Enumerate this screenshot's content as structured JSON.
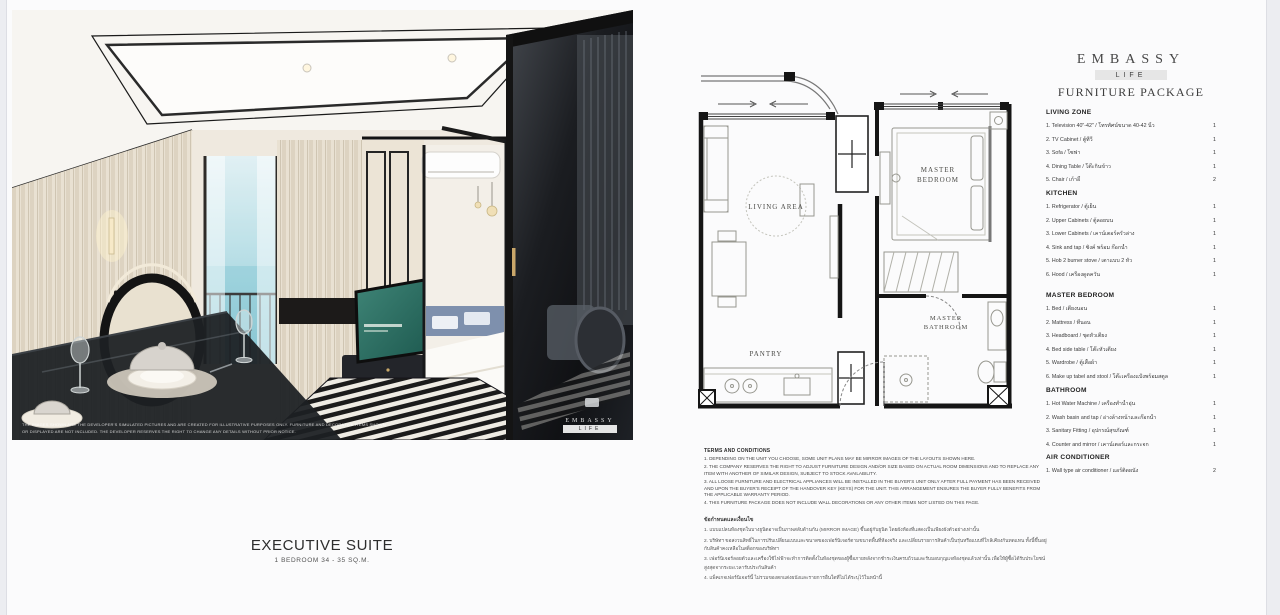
{
  "colors": {
    "page_bg": "#fbfbfc",
    "band_gray": "#e6e6e6",
    "text_dark": "#2f2f2f",
    "plan_wall": "#151515",
    "sea_view": "#8fccd8",
    "tv_screen": "#2e6f63"
  },
  "photo": {
    "watermark_line1": "THE IMAGES SHOWN ARE THE DEVELOPER'S SIMULATED PICTURES AND ARE CREATED FOR ILLUSTRATIVE PURPOSES ONLY. FURNITURE AND DECORATIVE ITEMS SHOWN",
    "watermark_line2": "OR DISPLAYED ARE NOT INCLUDED. THE DEVELOPER RESERVES THE RIGHT TO CHANGE ANY DETAILS WITHOUT PRIOR NOTICE.",
    "logo_name": "EMBASSY",
    "logo_sub": "LIFE"
  },
  "caption": {
    "title": "EXECUTIVE SUITE",
    "subtitle": "1 BEDROOM 34 - 35 SQ.M."
  },
  "floorplan": {
    "labels": {
      "living": "LIVING AREA",
      "bedroom_l1": "MASTER",
      "bedroom_l2": "BEDROOM",
      "pantry": "PANTRY",
      "bathroom_l1": "MASTER",
      "bathroom_l2": "BATHROOM"
    }
  },
  "brand": {
    "name": "EMBASSY",
    "sub": "LIFE",
    "package_title": "FURNITURE PACKAGE"
  },
  "furniture": {
    "sections": [
      {
        "title": "LIVING ZONE",
        "items": [
          {
            "label": "1. Television 40\"-42\" / โทรทัศน์ขนาด 40-42 นิ้ว",
            "qty": "1"
          },
          {
            "label": "2. TV Cabinet / ตู้ทีวี",
            "qty": "1"
          },
          {
            "label": "3. Sofa / โซฟา",
            "qty": "1"
          },
          {
            "label": "4. Dining Table / โต๊ะกินข้าว",
            "qty": "1"
          },
          {
            "label": "5. Chair / เก้าอี้",
            "qty": "2"
          }
        ]
      },
      {
        "title": "KITCHEN",
        "items": [
          {
            "label": "1. Refrigerator / ตู้เย็น",
            "qty": "1"
          },
          {
            "label": "2. Upper Cabinets / ตู้ลอยบน",
            "qty": "1"
          },
          {
            "label": "3. Lower Cabinets / เคาน์เตอร์ครัวล่าง",
            "qty": "1"
          },
          {
            "label": "4. Sink and tap / ซิงค์ พร้อม ก๊อกน้ำ",
            "qty": "1"
          },
          {
            "label": "5. Hob 2 burner stove / เตาแบบ 2 หัว",
            "qty": "1"
          },
          {
            "label": "6. Hood / เครื่องดูดควัน",
            "qty": "1"
          }
        ]
      },
      {
        "title": "MASTER BEDROOM",
        "items": [
          {
            "label": "1. Bed / เตียงนอน",
            "qty": "1"
          },
          {
            "label": "2. Mattress / ที่นอน",
            "qty": "1"
          },
          {
            "label": "3. Headboard / ชุดหัวเตียง",
            "qty": "1"
          },
          {
            "label": "4. Bed side table / โต๊ะหัวเตียง",
            "qty": "1"
          },
          {
            "label": "5. Wardrobe / ตู้เสื้อผ้า",
            "qty": "1"
          },
          {
            "label": "6. Make up tabel and stool / โต๊ะเครื่องแป้งพร้อมสตูล",
            "qty": "1"
          }
        ]
      },
      {
        "title": "BATHROOM",
        "items": [
          {
            "label": "1. Hot Water Machine / เครื่องทำน้ำอุ่น",
            "qty": "1"
          },
          {
            "label": "2. Wash basin and tap / อ่างล้างหน้าและก๊อกน้ำ",
            "qty": "1"
          },
          {
            "label": "3. Sanitary Fitting / อุปกรณ์สุขภัณฑ์",
            "qty": "1"
          },
          {
            "label": "4. Counter and mirror / เคาน์เตอร์และกระจก",
            "qty": "1"
          }
        ]
      },
      {
        "title": "AIR CONDITIONER",
        "items": [
          {
            "label": "1. Wall type air conditioner / แอร์ติดผนัง",
            "qty": "2"
          }
        ]
      }
    ]
  },
  "terms_en": {
    "title": "TERMS AND CONDITIONS",
    "lines": [
      "1. DEPENDING ON THE UNIT YOU CHOOSE, SOME UNIT PLANS MAY BE MIRROR IMAGES OF THE LAYOUTS SHOWN HERE.",
      "2. THE COMPANY RESERVES THE RIGHT TO ADJUST FURNITURE DESIGN AND/OR SIZE BASED ON ACTUAL ROOM DIMENSIONS AND TO REPLACE ANY ITEM WITH ANOTHER OF SIMILAR DESIGN, SUBJECT TO STOCK AVAILABILITY.",
      "3. ALL LOOSE FURNITURE AND ELECTRICAL APPLIANCES WILL BE INSTALLED IN THE BUYER'S UNIT ONLY AFTER FULL PAYMENT HAS BEEN RECEIVED AND UPON THE BUYER'S RECEIPT OF THE HANDOVER KEY (KEYS) FOR THE UNIT. THIS ARRANGEMENT ENSURES THE BUYER FULLY BENEFITS FROM THE APPLICABLE WARRANTY PERIOD.",
      "4. THIS FURNITURE PACKAGE DOES NOT INCLUDE WALL DECORATIONS OR ANY OTHER ITEMS NOT LISTED ON THIS PAGE."
    ]
  },
  "terms_th": {
    "title": "ข้อกำหนดและเงื่อนไข",
    "lines": [
      "1. แบบแปลนห้องชุดในบางยูนิตอาจเป็นภาพสลับด้านกัน (MIRROR IMAGE) ขึ้นอยู่กับยูนิต โดยผังห้องที่แสดงเป็นเพียงผังตัวอย่างเท่านั้น",
      "2. บริษัทฯ ขอสงวนสิทธิ์ในการปรับเปลี่ยนแบบและขนาดของเฟอร์นิเจอร์ตามขนาดพื้นที่ห้องจริง และเปลี่ยนรายการสินค้าเป็นรุ่นหรือแบบที่ใกล้เคียงกันทดแทน ทั้งนี้ขึ้นอยู่กับสินค้าคงเหลือในสต็อกของบริษัทฯ",
      "3. เฟอร์นิเจอร์ลอยตัวและเครื่องใช้ไฟฟ้าจะทำการติดตั้งในห้องชุดของผู้ซื้อภายหลังจากชำระเงินครบถ้วนและรับมอบกุญแจห้องชุดแล้วเท่านั้น เพื่อให้ผู้ซื้อได้รับประโยชน์สูงสุดจากระยะเวลารับประกันสินค้า",
      "4. แพ็คเกจเฟอร์นิเจอร์นี้ ไม่รวมของตกแต่งผนังและรายการอื่นใดที่ไม่ได้ระบุไว้ในหน้านี้"
    ]
  }
}
